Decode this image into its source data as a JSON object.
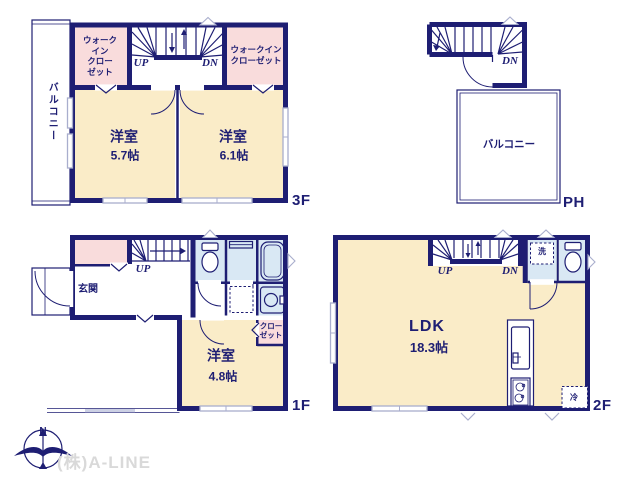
{
  "colors": {
    "wall": "#1e1e73",
    "cream": "#faecc8",
    "pink": "#f9dcdc",
    "bathblue": "#d9e8f4",
    "window": "#a9aecd",
    "watermark": "#d9d9d9"
  },
  "floors": {
    "f3": {
      "label": "3F",
      "balcony": "バルコニー",
      "wic_left": "ウォーク\nイン\nクロー\nゼット",
      "wic_right": "ウォークイン\nクローゼット",
      "stairs_up": "UP",
      "stairs_dn": "DN",
      "room1_name": "洋室",
      "room1_size": "5.7帖",
      "room2_name": "洋室",
      "room2_size": "6.1帖"
    },
    "ph": {
      "label": "PH",
      "stairs_dn": "DN",
      "balcony": "バルコニー"
    },
    "f1": {
      "label": "1F",
      "stairs_up": "UP",
      "entrance": "玄関",
      "room_name": "洋室",
      "room_size": "4.8帖",
      "closet": "クロー\nゼット"
    },
    "f2": {
      "label": "2F",
      "stairs_up": "UP",
      "stairs_dn": "DN",
      "laundry": "洗",
      "ldk_name": "LDK",
      "ldk_size": "18.3帖",
      "fridge": "冷"
    }
  },
  "footer": {
    "compass_n": "N",
    "company": "(株)A-LINE"
  }
}
